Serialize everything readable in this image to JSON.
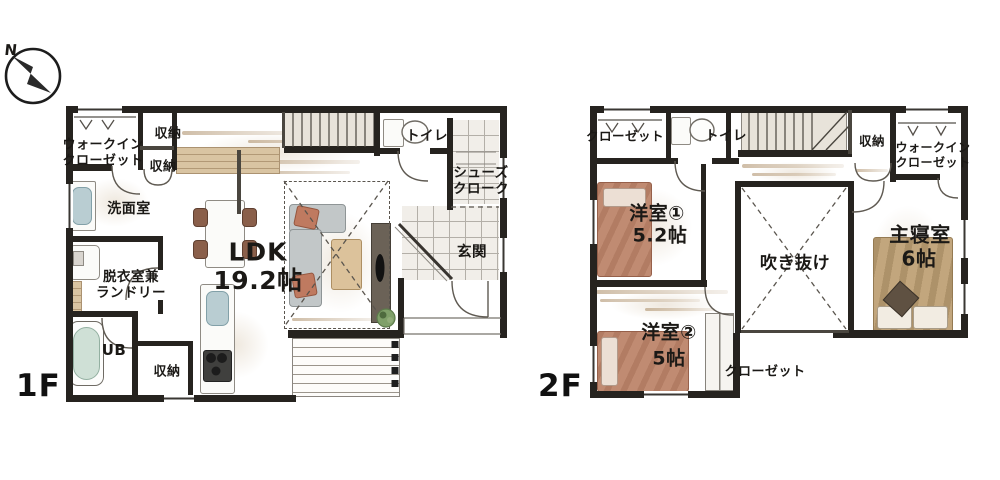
{
  "compass": {
    "north_label": "N"
  },
  "floor1": {
    "label": "1F",
    "walk_in_closet": {
      "line1": "ウォークイン",
      "line2": "クローゼット"
    },
    "storage_top_a": "収納",
    "storage_top_b": "収納",
    "washroom": "洗面室",
    "laundry": {
      "line1": "脱衣室兼",
      "line2": "ランドリー"
    },
    "unit_bath": "UB",
    "storage_bottom": "収納",
    "ldk": {
      "name": "LDK",
      "size": "19.2帖"
    },
    "toilet": "トイレ",
    "shoe_closet": {
      "line1": "シューズ",
      "line2": "クローク"
    },
    "entrance": "玄関"
  },
  "floor2": {
    "label": "2F",
    "closet_top": "クローゼット",
    "toilet": "トイレ",
    "storage": "収納",
    "walk_in_closet": {
      "line1": "ウォークイン",
      "line2": "クローゼット"
    },
    "room1": {
      "name": "洋室①",
      "size": "5.2帖"
    },
    "void": "吹き抜け",
    "master": {
      "name": "主寝室",
      "size": "6帖"
    },
    "room2": {
      "name": "洋室②",
      "size": "5帖"
    },
    "closet_bottom": "クローゼット"
  }
}
